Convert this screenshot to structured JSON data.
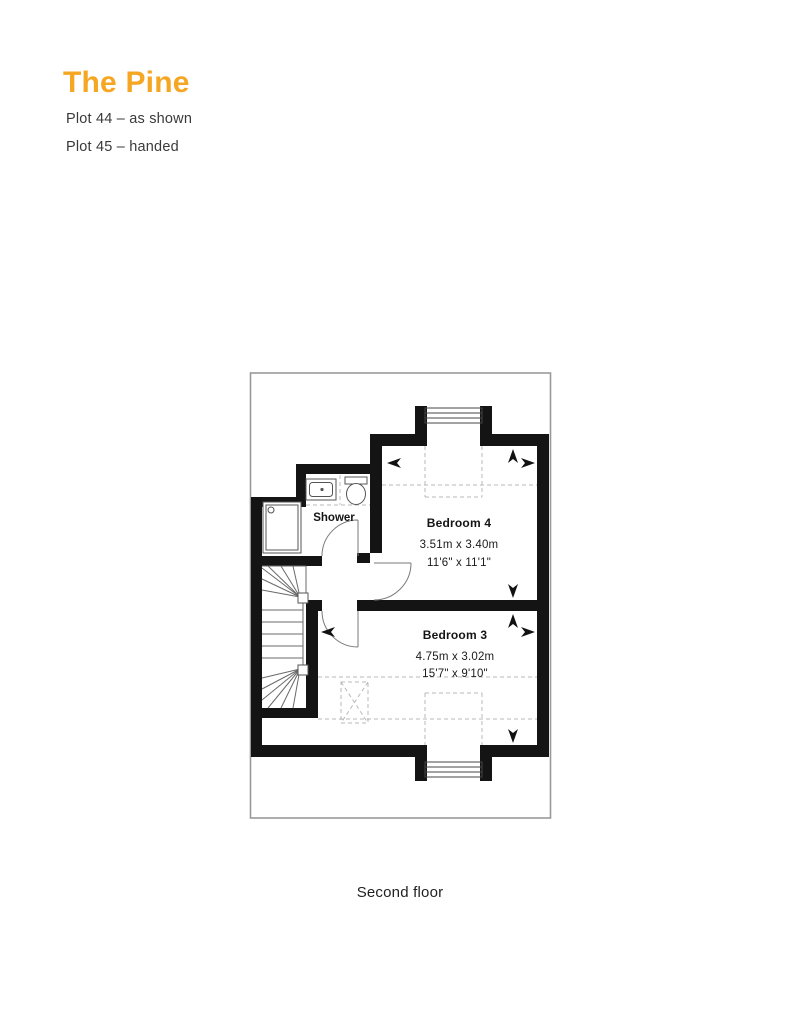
{
  "header": {
    "title": "The Pine",
    "accent_color": "#F5A623",
    "plots": [
      {
        "label": "Plot 44 – as shown"
      },
      {
        "label": "Plot 45 – handed"
      }
    ]
  },
  "floorplan": {
    "caption": "Second floor",
    "shower": {
      "name": "Shower"
    },
    "bedroom4": {
      "name": "Bedroom 4",
      "metric": "3.51m x 3.40m",
      "imperial": "11'6\" x 11'1\""
    },
    "bedroom3": {
      "name": "Bedroom 3",
      "metric": "4.75m x 3.02m",
      "imperial": "15'7\" x 9'10\""
    }
  }
}
